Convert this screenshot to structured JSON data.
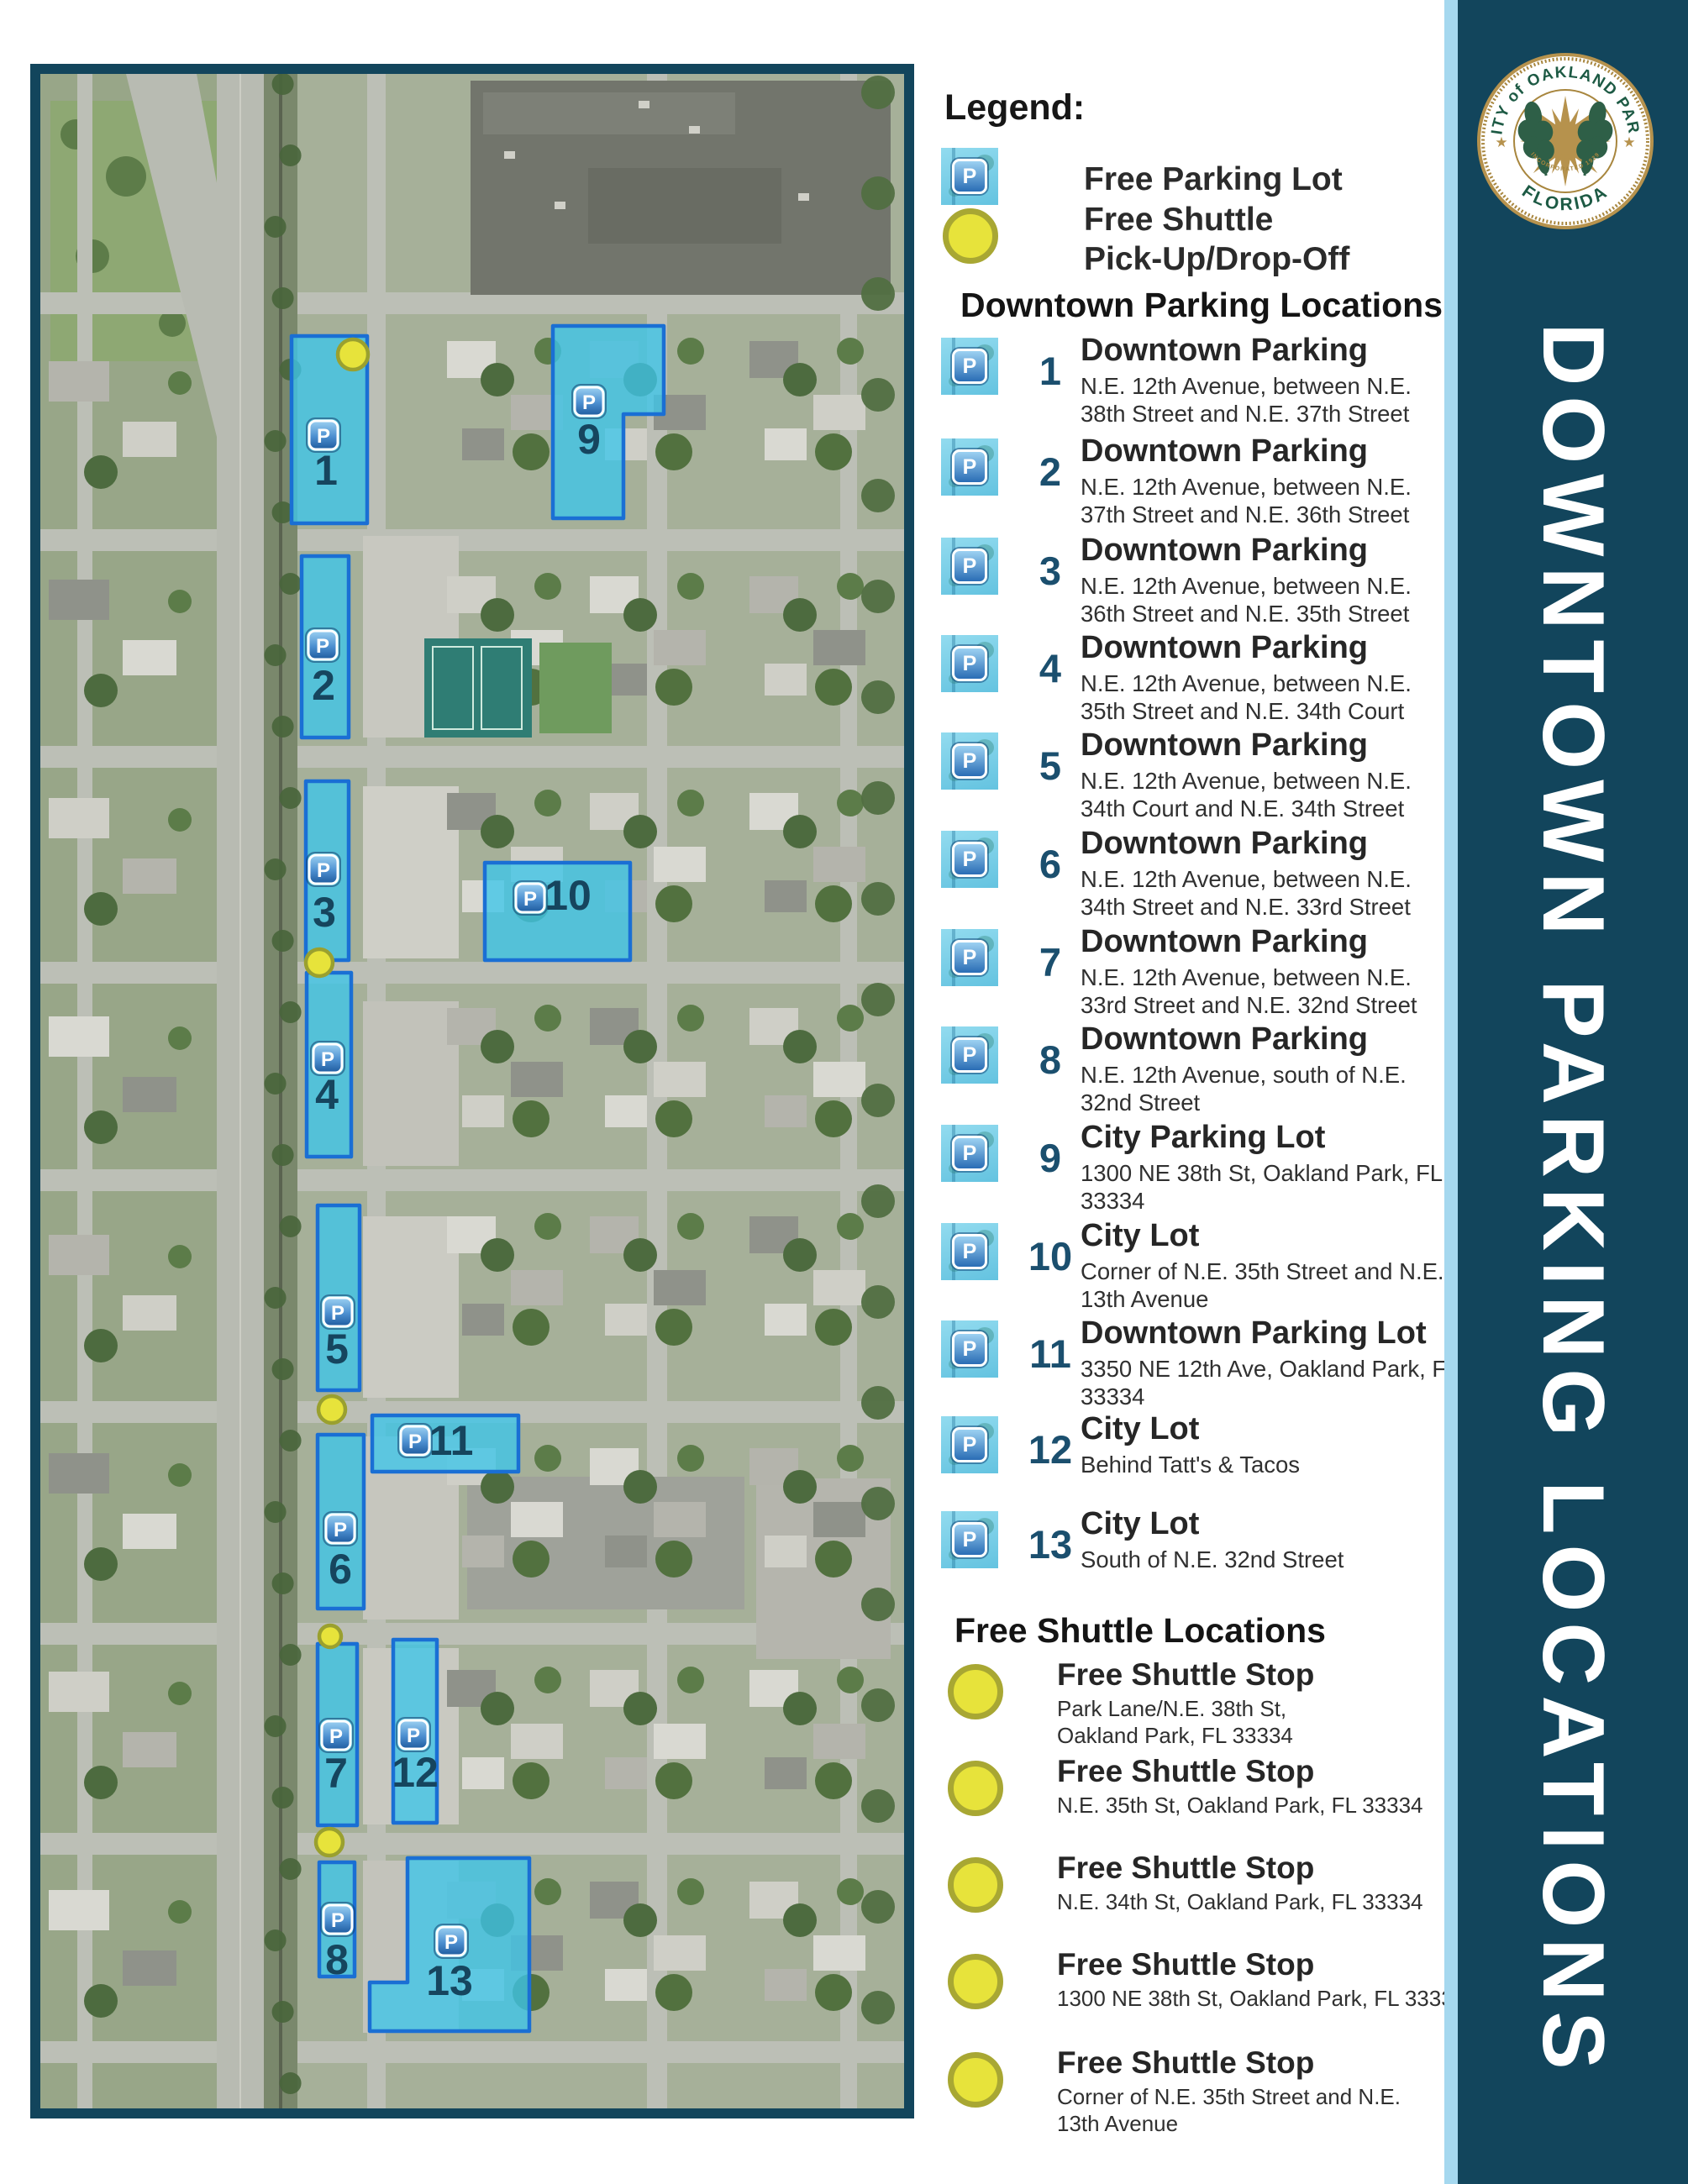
{
  "banner": {
    "title": "DOWNTOWN PARKING LOCATIONS"
  },
  "seal": {
    "top_text": "CITY of OAKLAND PARK",
    "bottom_text": "FLORIDA",
    "incorporated_text": "INCORPORATED 1929",
    "star": "★"
  },
  "legend": {
    "heading": "Legend:",
    "free_parking_label": "Free Parking Lot",
    "free_shuttle_label_line1": "Free Shuttle",
    "free_shuttle_label_line2": "Pick-Up/Drop-Off"
  },
  "parking_section": {
    "heading": "Downtown Parking Locations",
    "entries": [
      {
        "num": "1",
        "title": "Downtown Parking",
        "address": "N.E. 12th Avenue, between N.E. 38th Street and N.E. 37th Street"
      },
      {
        "num": "2",
        "title": "Downtown Parking",
        "address": "N.E. 12th Avenue, between N.E. 37th Street and N.E. 36th Street"
      },
      {
        "num": "3",
        "title": "Downtown Parking",
        "address": "N.E. 12th Avenue, between N.E. 36th Street and N.E. 35th Street"
      },
      {
        "num": "4",
        "title": "Downtown Parking",
        "address": "N.E. 12th Avenue, between N.E. 35th Street and N.E. 34th Court"
      },
      {
        "num": "5",
        "title": "Downtown Parking",
        "address": "N.E. 12th Avenue, between N.E. 34th Court and N.E. 34th Street"
      },
      {
        "num": "6",
        "title": "Downtown Parking",
        "address": "N.E. 12th Avenue, between N.E. 34th Street and N.E. 33rd Street"
      },
      {
        "num": "7",
        "title": "Downtown Parking",
        "address": "N.E. 12th Avenue, between N.E. 33rd Street and N.E. 32nd Street"
      },
      {
        "num": "8",
        "title": "Downtown Parking",
        "address": "N.E. 12th Avenue, south of N.E. 32nd Street"
      },
      {
        "num": "9",
        "title": "City Parking Lot",
        "address": "1300 NE 38th St, Oakland Park, FL 33334"
      },
      {
        "num": "10",
        "title": "City Lot",
        "address": "Corner of N.E. 35th Street and N.E. 13th Avenue"
      },
      {
        "num": "11",
        "title": "Downtown Parking Lot",
        "address": "3350 NE 12th Ave, Oakland Park, FL 33334"
      },
      {
        "num": "12",
        "title": "City Lot",
        "address": "Behind Tatt's & Tacos"
      },
      {
        "num": "13",
        "title": "City Lot",
        "address": "South of N.E. 32nd Street"
      }
    ]
  },
  "shuttle_section": {
    "heading": "Free Shuttle Locations",
    "entries": [
      {
        "title": "Free Shuttle Stop",
        "address": "Park Lane/N.E. 38th St,\nOakland Park, FL 33334"
      },
      {
        "title": "Free Shuttle Stop",
        "address": "N.E. 35th St, Oakland Park, FL 33334"
      },
      {
        "title": "Free Shuttle Stop",
        "address": "N.E. 34th St, Oakland Park, FL 33334"
      },
      {
        "title": "Free Shuttle Stop",
        "address": "1300 NE 38th St, Oakland Park, FL 33334"
      },
      {
        "title": "Free Shuttle Stop",
        "address": "Corner of N.E. 35th Street and N.E.\n13th Avenue"
      }
    ]
  },
  "map": {
    "p_symbol": "P",
    "lots": [
      {
        "label": "1"
      },
      {
        "label": "2"
      },
      {
        "label": "3"
      },
      {
        "label": "4"
      },
      {
        "label": "5"
      },
      {
        "label": "6"
      },
      {
        "label": "7"
      },
      {
        "label": "8"
      },
      {
        "label": "9"
      },
      {
        "label": "10"
      },
      {
        "label": "11"
      },
      {
        "label": "12"
      },
      {
        "label": "13"
      }
    ],
    "shuttle_stops": [
      {
        "id": "stop-1"
      },
      {
        "id": "stop-2"
      },
      {
        "id": "stop-3"
      },
      {
        "id": "stop-4"
      },
      {
        "id": "stop-5"
      }
    ]
  },
  "colors": {
    "navy": "#12455C",
    "light_blue": "#A5D8EF",
    "lot_fill": "#3EC5E9",
    "lot_border": "#1A6FD4",
    "shuttle_yellow": "#E7E33B"
  }
}
